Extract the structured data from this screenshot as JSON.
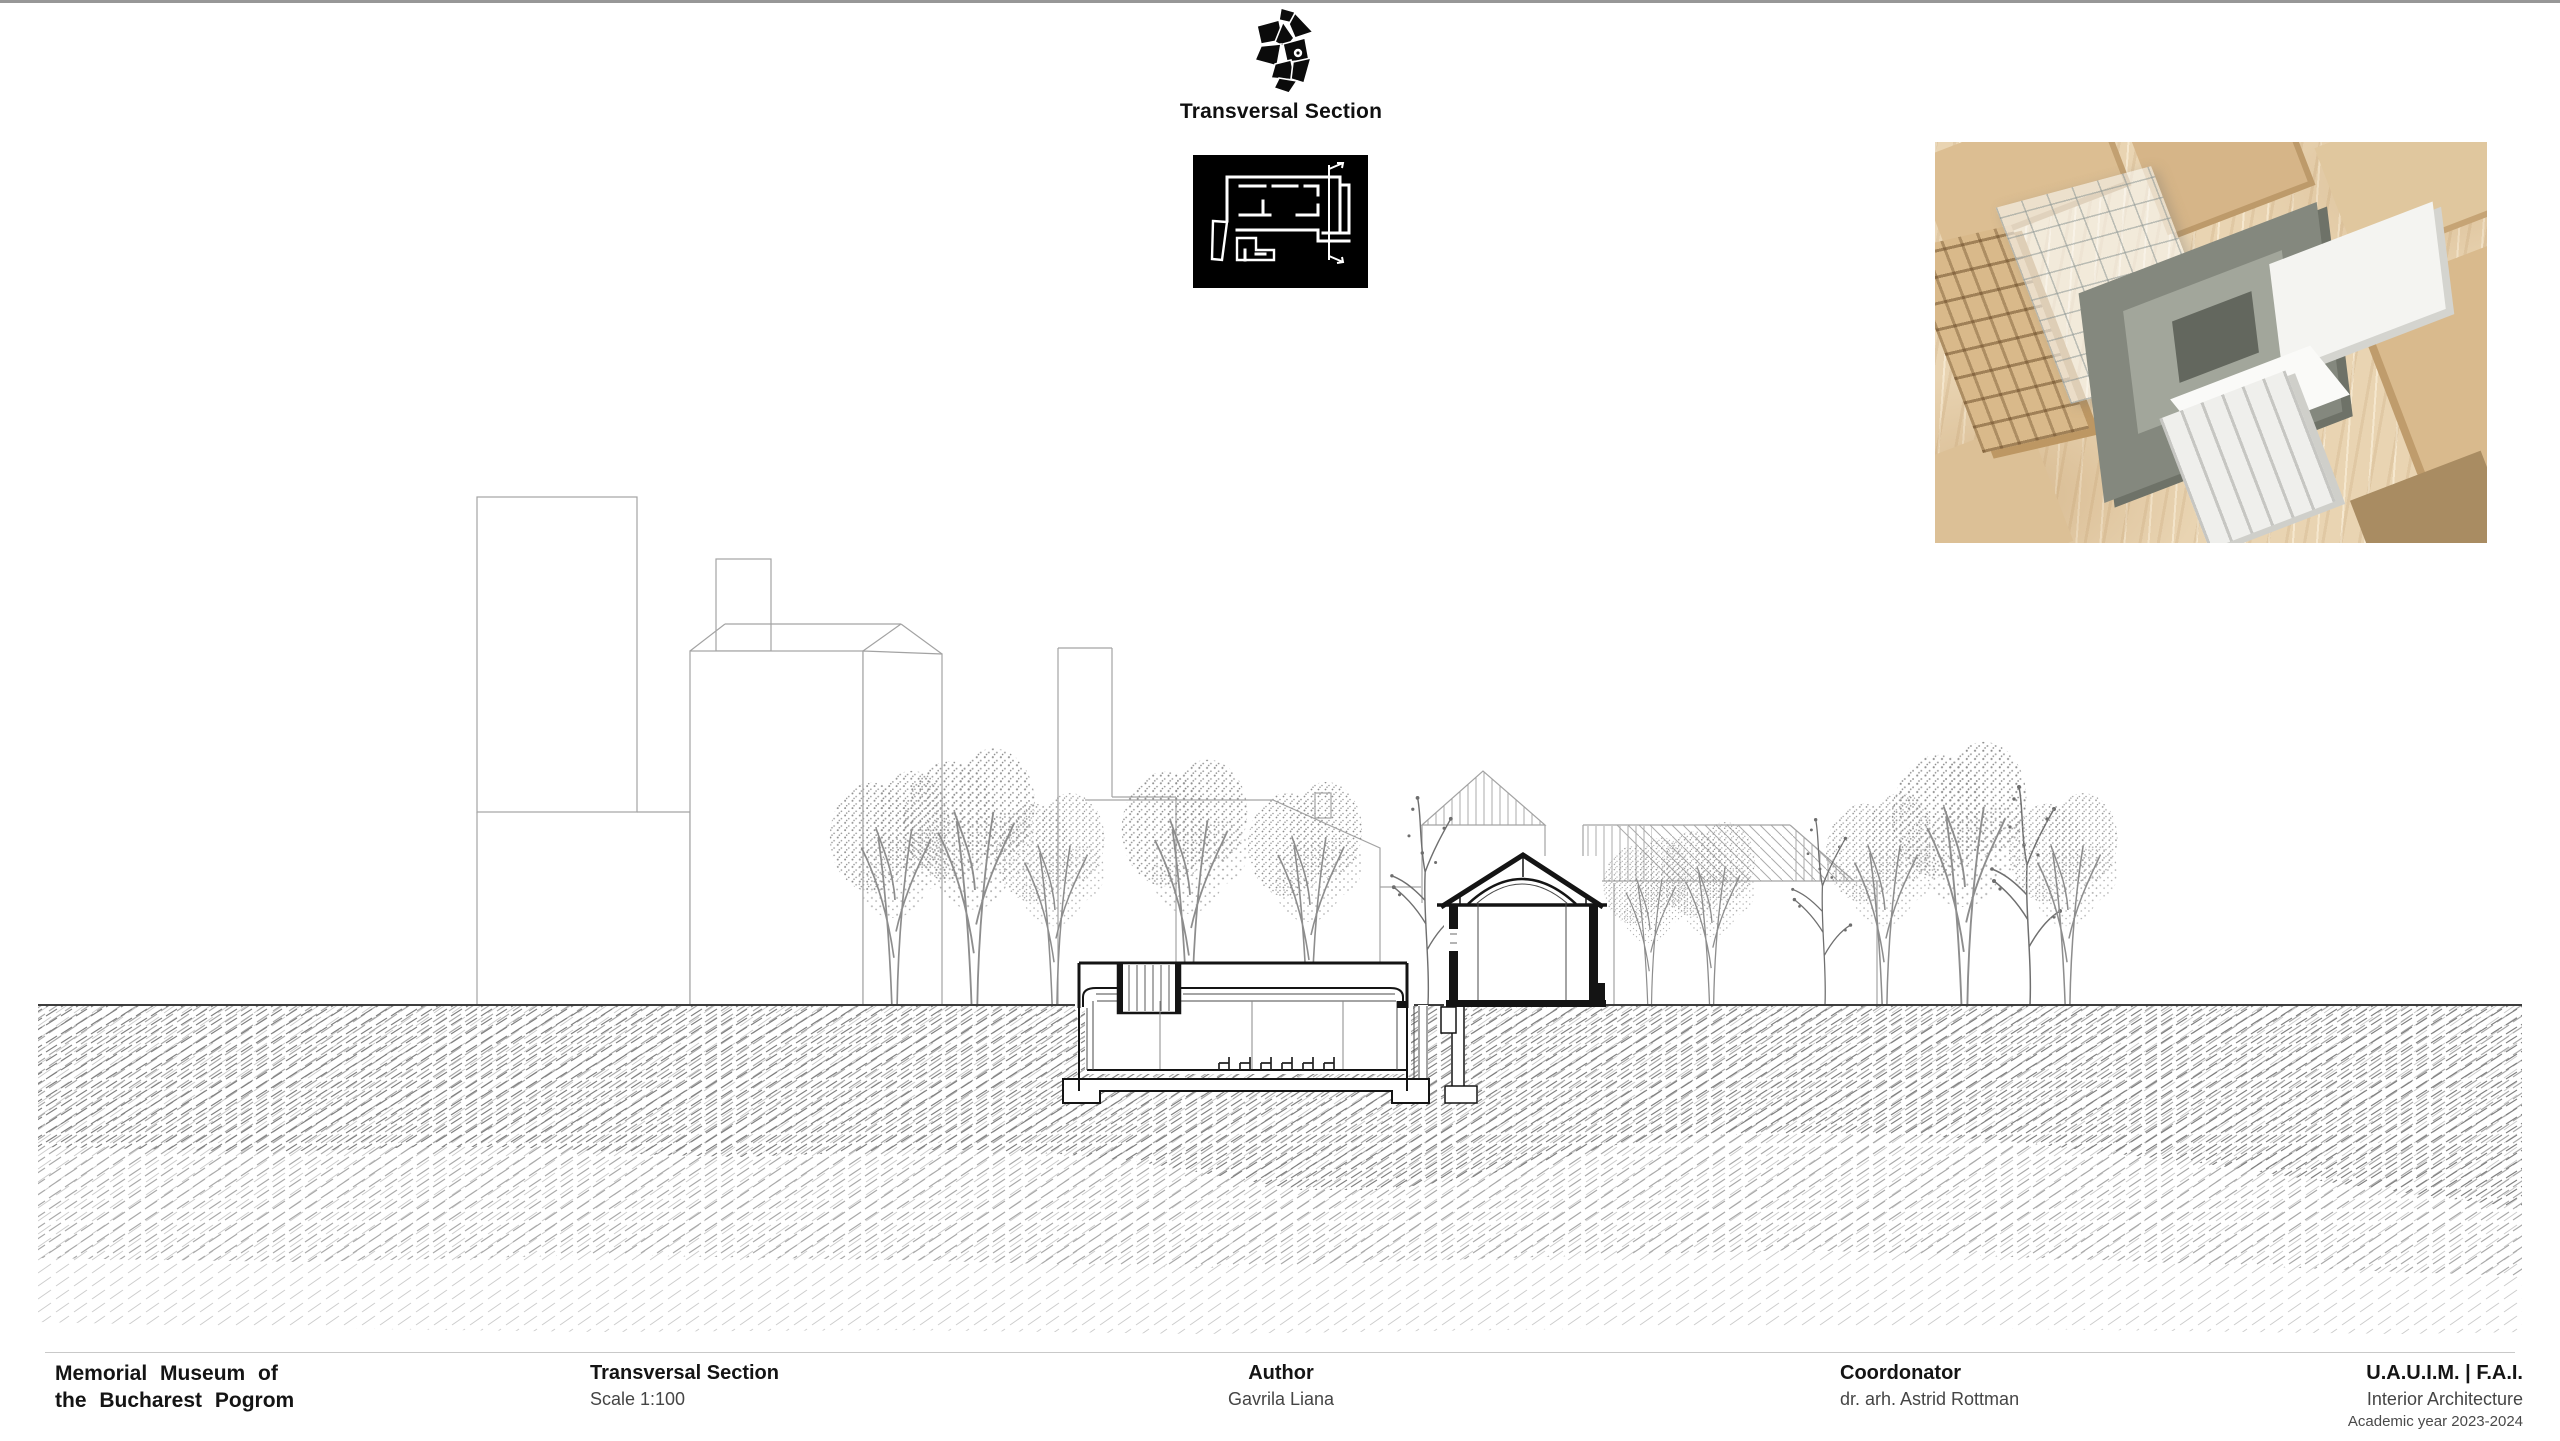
{
  "header": {
    "title": "Transversal Section"
  },
  "key_plan": {
    "icon": "section-cut-key-plan"
  },
  "model_photo": {
    "icon": "physical-model-photograph"
  },
  "title_block": {
    "project": {
      "line1": "Memorial Museum of",
      "line2": "the Bucharest Pogrom"
    },
    "drawing": {
      "title": "Transversal Section",
      "scale": "Scale 1:100"
    },
    "author": {
      "label": "Author",
      "name": "Gavrila Liana"
    },
    "coordinator": {
      "label": "Coordonator",
      "name": "dr. arh. Astrid Rottman"
    },
    "institution": {
      "name": "U.A.U.I.M. | F.A.I.",
      "department": "Interior Architecture",
      "academic_year": "Academic year 2023-2024"
    }
  },
  "colors": {
    "ink": "#141414",
    "outline_gray": "#a3a3a3",
    "hatch_dark": "#7f7f7f",
    "hatch_medium": "#a9a9a9",
    "hatch_light": "#cccccc",
    "wood": "#e9d4b2",
    "concrete": "#84887e",
    "model_white": "#f4f4f1",
    "keyplan_bg": "#000000"
  }
}
